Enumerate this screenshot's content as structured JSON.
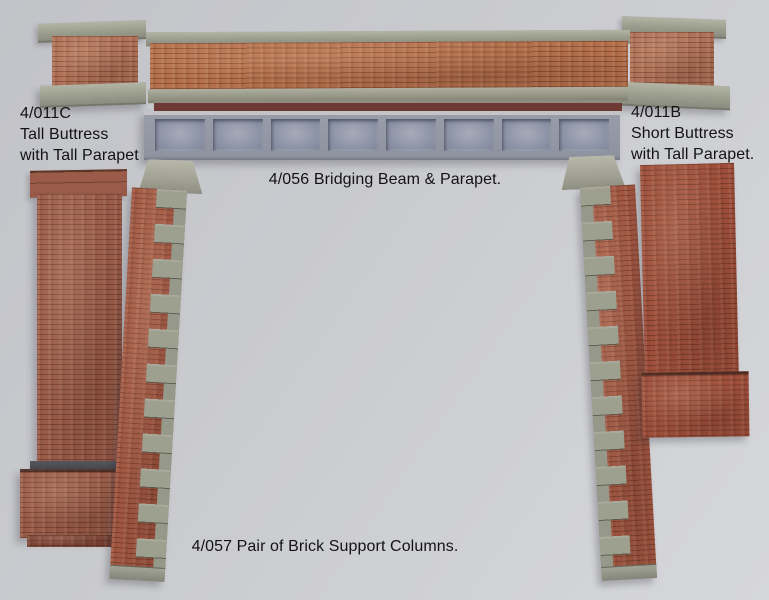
{
  "labels": {
    "tall_buttress": {
      "code": "4/011C",
      "line2": "Tall Buttress",
      "line3": "with Tall Parapet"
    },
    "short_buttress": {
      "code": "4/011B",
      "line2": "Short Buttress",
      "line3": "with Tall Parapet."
    },
    "bridging_beam": "4/056 Bridging Beam & Parapet.",
    "support_columns": "4/057 Pair of Brick Support Columns."
  },
  "beam": {
    "panel_count": 8
  },
  "colors": {
    "background_top": "#c2c3c8",
    "background_bottom": "#d6d7da",
    "brick_parapet": "#b5714c",
    "brick_blocks": "#b07258",
    "brick_buttress_left": "#9a5c49",
    "brick_columns": "#a15742",
    "brick_buttress_right": "#9d4f3b",
    "stone": "#9da08f",
    "beam_frame": "#999daa",
    "beam_panel": "#8a90a4",
    "beam_panel_light": "#a6abb9",
    "maroon": "#6f3a33",
    "engineering_band": "#44454b",
    "text": "#131313"
  }
}
